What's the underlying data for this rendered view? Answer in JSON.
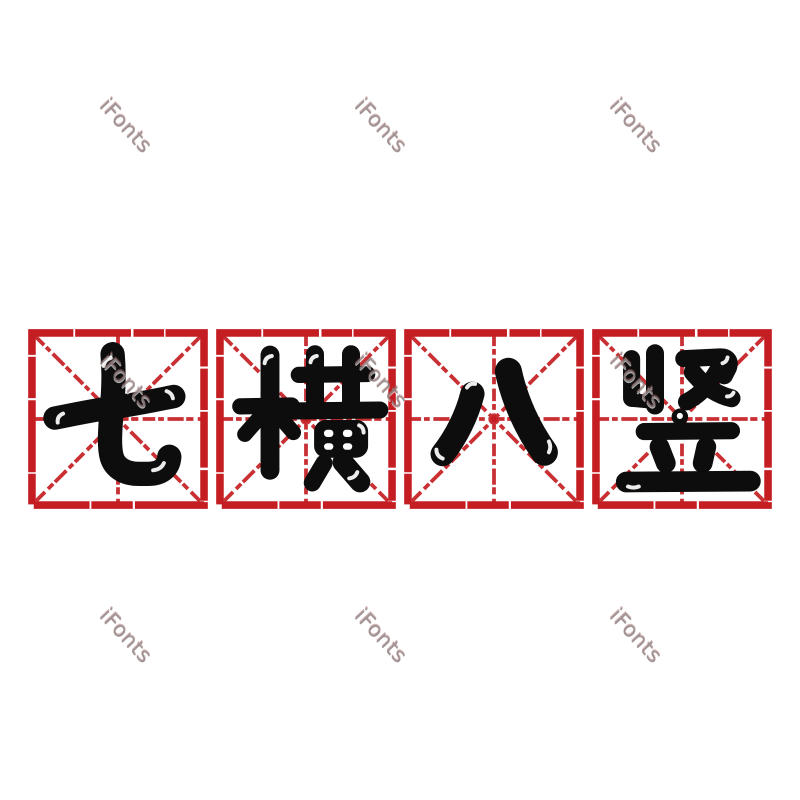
{
  "style": {
    "background": "#ffffff",
    "line_color": "#c41e23",
    "glyph_color": "#0d0d0d",
    "highlight_color": "#ffffff",
    "watermark_color": "#938484"
  },
  "watermark": {
    "text": "iFonts"
  },
  "phrase": "七横八竖",
  "cells": [
    {
      "char": "七"
    },
    {
      "char": "横"
    },
    {
      "char": "八"
    },
    {
      "char": "竖"
    }
  ]
}
